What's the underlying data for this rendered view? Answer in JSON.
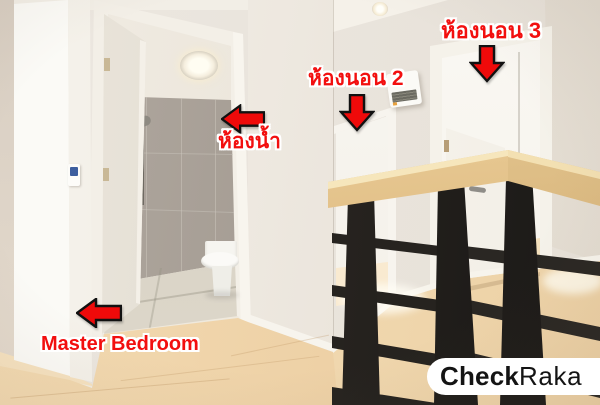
{
  "annotations": [
    {
      "id": "bedroom3",
      "label": "ห้องนอน 3",
      "arrow_direction": "down"
    },
    {
      "id": "bedroom2",
      "label": "ห้องนอน 2",
      "arrow_direction": "down"
    },
    {
      "id": "bathroom",
      "label": "ห้องน้ำ",
      "arrow_direction": "left"
    },
    {
      "id": "master_bedroom",
      "label": "Master Bedroom",
      "arrow_direction": "left"
    }
  ],
  "watermark": {
    "text": "CheckRaka",
    "bold_part": "Check",
    "light_part": "Raka"
  },
  "colors": {
    "annotation_red": "#f20f0f",
    "annotation_text_outline": "#ffffff",
    "arrow_fill": "#ef0a0a",
    "arrow_outline": "#111111",
    "wall": "#eae5dd",
    "tile_wall": "#a39a91",
    "handrail_wood": "#e3c189",
    "railing_metal": "#232120",
    "floor_wood": "#eccfa3",
    "watermark_bg": "#ffffff",
    "watermark_text": "#141414"
  }
}
